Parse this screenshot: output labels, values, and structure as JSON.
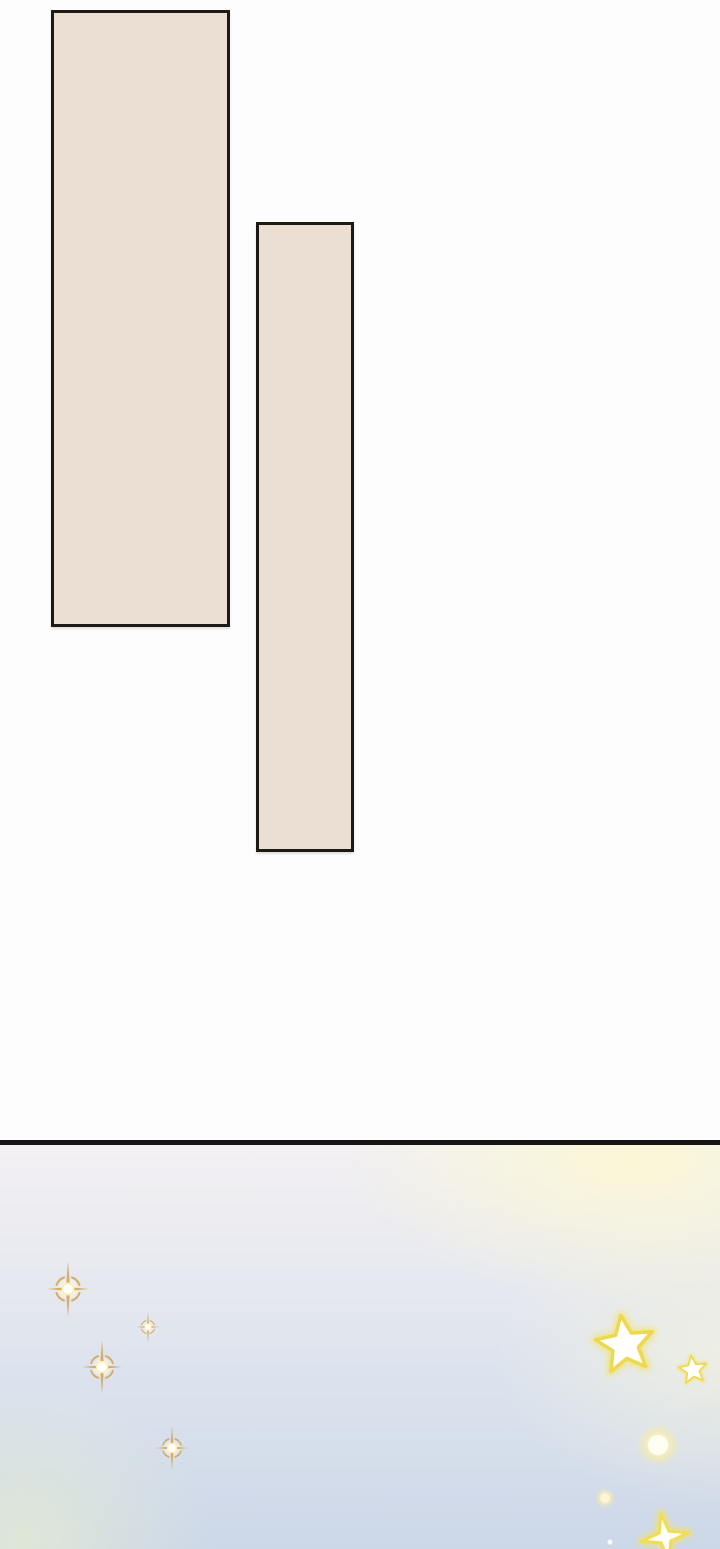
{
  "scene": {
    "description": "webtoon-page-segment",
    "text_content": "none"
  },
  "colors": {
    "page-bg": "#fdfdfd",
    "panel-fill": "#eadfd2",
    "panel-border": "#1d1a16",
    "divider": "#161616",
    "sky-top": "#f2f0f2",
    "sky-bottom": "#ccd7e8",
    "sky-yellow": "#fbf7d6",
    "sparkle-gold": "#d2a452",
    "star-yellow": "#eed84e",
    "glow-white": "#fffef5"
  },
  "panels": [
    {
      "name": "comic-panel-1",
      "left": 51,
      "top": 10,
      "width": 179,
      "height": 617
    },
    {
      "name": "comic-panel-2",
      "left": 256,
      "top": 222,
      "width": 98,
      "height": 630
    }
  ],
  "divider": {
    "top": 1140,
    "height": 5
  },
  "sky": {
    "top": 1145,
    "height": 404,
    "decorations": [
      {
        "type": "sparkle8",
        "name": "gold-cross-sparkle-large",
        "x": 68,
        "y": 144,
        "scale": 1
      },
      {
        "type": "sparkle8",
        "name": "gold-cross-sparkle-small",
        "x": 148,
        "y": 182,
        "scale": 0.55
      },
      {
        "type": "sparkle8",
        "name": "gold-cross-sparkle-medium",
        "x": 102,
        "y": 222,
        "scale": 0.95
      },
      {
        "type": "sparkle8",
        "name": "gold-cross-sparkle-lower",
        "x": 172,
        "y": 303,
        "scale": 0.78
      },
      {
        "type": "star5",
        "name": "big-yellow-star",
        "x": 625,
        "y": 200,
        "scale": 1
      },
      {
        "type": "star5",
        "name": "small-yellow-star",
        "x": 693,
        "y": 225,
        "scale": 0.48
      },
      {
        "type": "gloworb",
        "name": "glowing-orb",
        "x": 658,
        "y": 300,
        "scale": 1
      },
      {
        "type": "glowdot",
        "name": "small-glow-dot",
        "x": 605,
        "y": 353,
        "scale": 1
      },
      {
        "type": "star4",
        "name": "four-point-star-clipped",
        "x": 665,
        "y": 392,
        "scale": 1
      },
      {
        "type": "dot",
        "name": "tiny-white-dot",
        "x": 610,
        "y": 397,
        "scale": 1
      }
    ]
  }
}
